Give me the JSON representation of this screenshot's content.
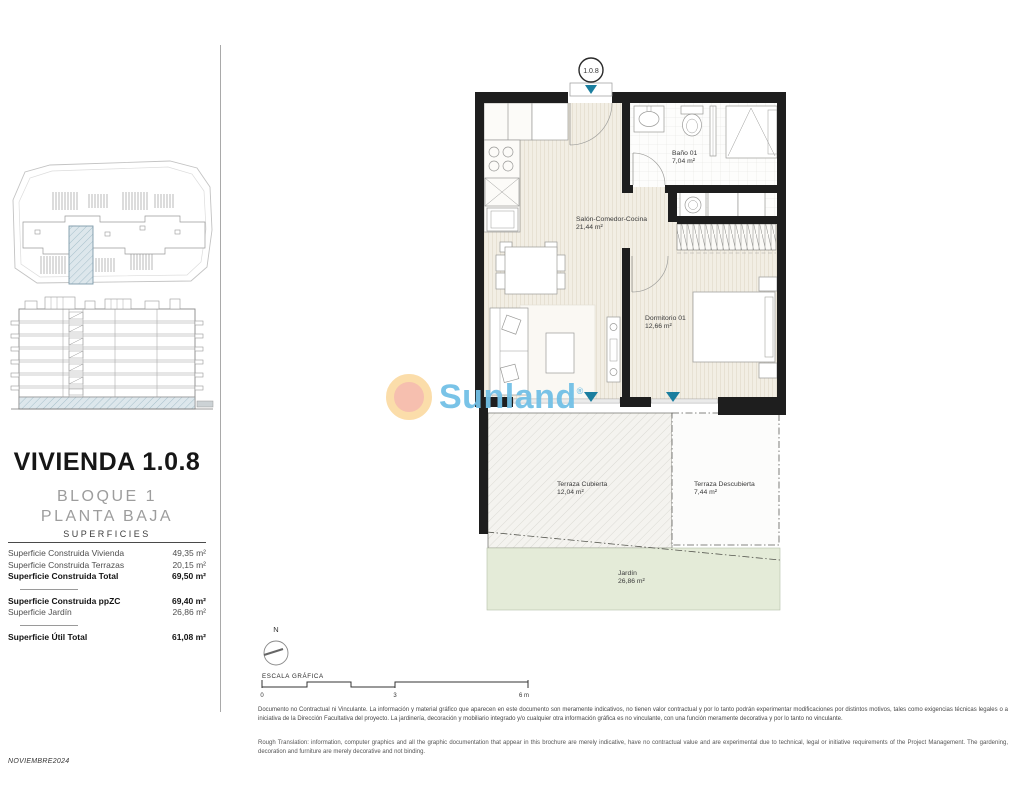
{
  "document": {
    "date_code": "NOVIEMBRE2024"
  },
  "title_block": {
    "title": "VIVIENDA 1.0.8",
    "block": "BLOQUE 1",
    "floor": "PLANTA BAJA",
    "table_title": "SUPERFICIES",
    "rows": [
      {
        "label": "Superficie Construida Vivienda",
        "value": "49,35 m²"
      },
      {
        "label": "Superficie Construida Terrazas",
        "value": "20,15 m²"
      },
      {
        "label": "Superficie Construida Total",
        "value": "69,50 m²"
      },
      {
        "label": "Superficie Construida ppZC",
        "value": "69,40 m²"
      },
      {
        "label": "Superficie Jardín",
        "value": "26,86 m²"
      },
      {
        "label": "Superficie Útil Total",
        "value": "61,08 m²"
      }
    ]
  },
  "floor_plan": {
    "unit_label": "1.0.8",
    "rooms": [
      {
        "name": "Salón-Comedor-Cocina",
        "area": "21,44 m²"
      },
      {
        "name": "Baño 01",
        "area": "7,04 m²"
      },
      {
        "name": "Dormitorio 01",
        "area": "12,66 m²"
      },
      {
        "name": "Terraza Cubierta",
        "area": "12,04 m²"
      },
      {
        "name": "Terraza Descubierta",
        "area": "7,44 m²"
      },
      {
        "name": "Jardín",
        "area": "26,86 m²"
      }
    ]
  },
  "scale": {
    "north_label": "N",
    "label": "ESCALA GRÁFICA",
    "ticks": [
      "0",
      "3",
      "6 m"
    ]
  },
  "watermark": {
    "brand": "Sunland",
    "reg": "®"
  },
  "disclaimer": {
    "spanish": "Documento no Contractual ni Vinculante. La información y material gráfico que aparecen en este documento son meramente indicativos, no tienen valor contractual y por lo tanto podrán experimentar modificaciones por distintos motivos, tales como exigencias técnicas legales o a iniciativa de la Dirección Facultativa del proyecto. La jardinería, decoración y mobiliario integrado y/o cualquier otra información gráfica es no vinculante, con una función meramente decorativa y por lo tanto no vinculante.",
    "english": "Rough Translation: information, computer graphics and all the graphic documentation that appear in this brochure are merely indicative, have no contractual value and are experimental due to technical, legal or initiative requirements of the Project Management. The gardening, decoration and furniture are merely decorative and not binding."
  },
  "colors": {
    "wall": "#1e1e1e",
    "floor": "#f2eee4",
    "garden": "#e4ebd8",
    "teal_marker": "#1b7e9f",
    "watermark_blue": "#72c0e6",
    "sun_outer": "#fbdca6",
    "sun_inner": "#f6bcab"
  }
}
